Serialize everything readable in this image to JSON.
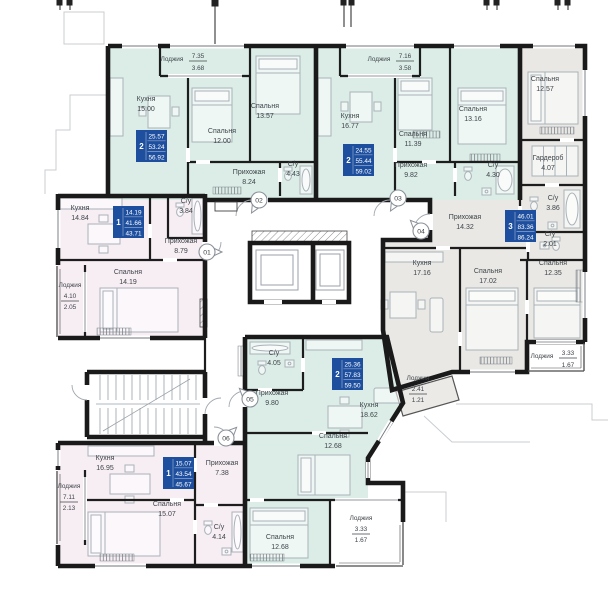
{
  "floorplan": {
    "colors": {
      "teal": "#dcede7",
      "pink": "#f7eef3",
      "grey": "#e9e8e4",
      "badge_blue": "#1e4f9e",
      "wall": "#1a1a1a"
    },
    "apartments": [
      {
        "number": "01",
        "rooms_count": "1",
        "stats": {
          "living": "14.19",
          "area": "41.66",
          "total": "43.71"
        },
        "rooms": [
          {
            "name": "Кухня",
            "area": "14.84"
          },
          {
            "name": "С/у",
            "area": "3.84"
          },
          {
            "name": "Прихожая",
            "area": "8.79"
          },
          {
            "name": "Спальня",
            "area": "14.19"
          }
        ],
        "loggias": [
          {
            "name": "Лоджия",
            "over": "4.10",
            "under": "2.05"
          }
        ]
      },
      {
        "number": "02",
        "rooms_count": "2",
        "stats": {
          "living": "25.57",
          "area": "53.24",
          "total": "56.92"
        },
        "rooms": [
          {
            "name": "Кухня",
            "area": "15.00"
          },
          {
            "name": "Спальня",
            "area": "12.00"
          },
          {
            "name": "Спальня",
            "area": "13.57"
          },
          {
            "name": "Прихожая",
            "area": "8.24"
          },
          {
            "name": "С/у",
            "area": "4.43"
          }
        ],
        "loggias": [
          {
            "name": "Лоджия",
            "over": "7.35",
            "under": "3.68"
          }
        ]
      },
      {
        "number": "03",
        "rooms_count": "2",
        "stats": {
          "living": "24.55",
          "area": "55.44",
          "total": "59.02"
        },
        "rooms": [
          {
            "name": "Кухня",
            "area": "16.77"
          },
          {
            "name": "Спальня",
            "area": "11.39"
          },
          {
            "name": "Спальня",
            "area": "13.16"
          },
          {
            "name": "Прихожая",
            "area": "9.82"
          },
          {
            "name": "С/у",
            "area": "4.30"
          }
        ],
        "loggias": [
          {
            "name": "Лоджия",
            "over": "7.16",
            "under": "3.58"
          }
        ]
      },
      {
        "number": "04",
        "rooms_count": "3",
        "stats": {
          "living": "46.01",
          "area": "83.36",
          "total": "86.24"
        },
        "rooms": [
          {
            "name": "Спальня",
            "area": "12.57"
          },
          {
            "name": "Гардероб",
            "area": "4.07"
          },
          {
            "name": "С/у",
            "area": "3.86"
          },
          {
            "name": "С/у",
            "area": "2.01"
          },
          {
            "name": "Прихожая",
            "area": "14.32"
          },
          {
            "name": "Кухня",
            "area": "17.16"
          },
          {
            "name": "Спальня",
            "area": "17.02"
          },
          {
            "name": "Спальня",
            "area": "12.35"
          }
        ],
        "loggias": [
          {
            "name": "Лоджия",
            "over": "3.33",
            "under": "1.67"
          },
          {
            "name": "Лоджия",
            "over": "2.41",
            "under": "1.21"
          }
        ]
      },
      {
        "number": "05",
        "rooms_count": "2",
        "stats": {
          "living": "25.36",
          "area": "57.83",
          "total": "59.50"
        },
        "rooms": [
          {
            "name": "С/у",
            "area": "4.05"
          },
          {
            "name": "Прихожая",
            "area": "9.80"
          },
          {
            "name": "Кухня",
            "area": "18.62"
          },
          {
            "name": "Спальня",
            "area": "12.68"
          },
          {
            "name": "Спальня",
            "area": "12.68"
          }
        ],
        "loggias": [
          {
            "name": "Лоджия",
            "over": "3.33",
            "under": "1.67"
          }
        ]
      },
      {
        "number": "06",
        "rooms_count": "1",
        "stats": {
          "living": "15.07",
          "area": "43.54",
          "total": "45.67"
        },
        "rooms": [
          {
            "name": "Кухня",
            "area": "16.95"
          },
          {
            "name": "Прихожая",
            "area": "7.38"
          },
          {
            "name": "Спальня",
            "area": "15.07"
          },
          {
            "name": "С/у",
            "area": "4.14"
          }
        ],
        "loggias": [
          {
            "name": "Лоджия",
            "over": "7.11",
            "under": "2.13"
          }
        ]
      }
    ]
  }
}
